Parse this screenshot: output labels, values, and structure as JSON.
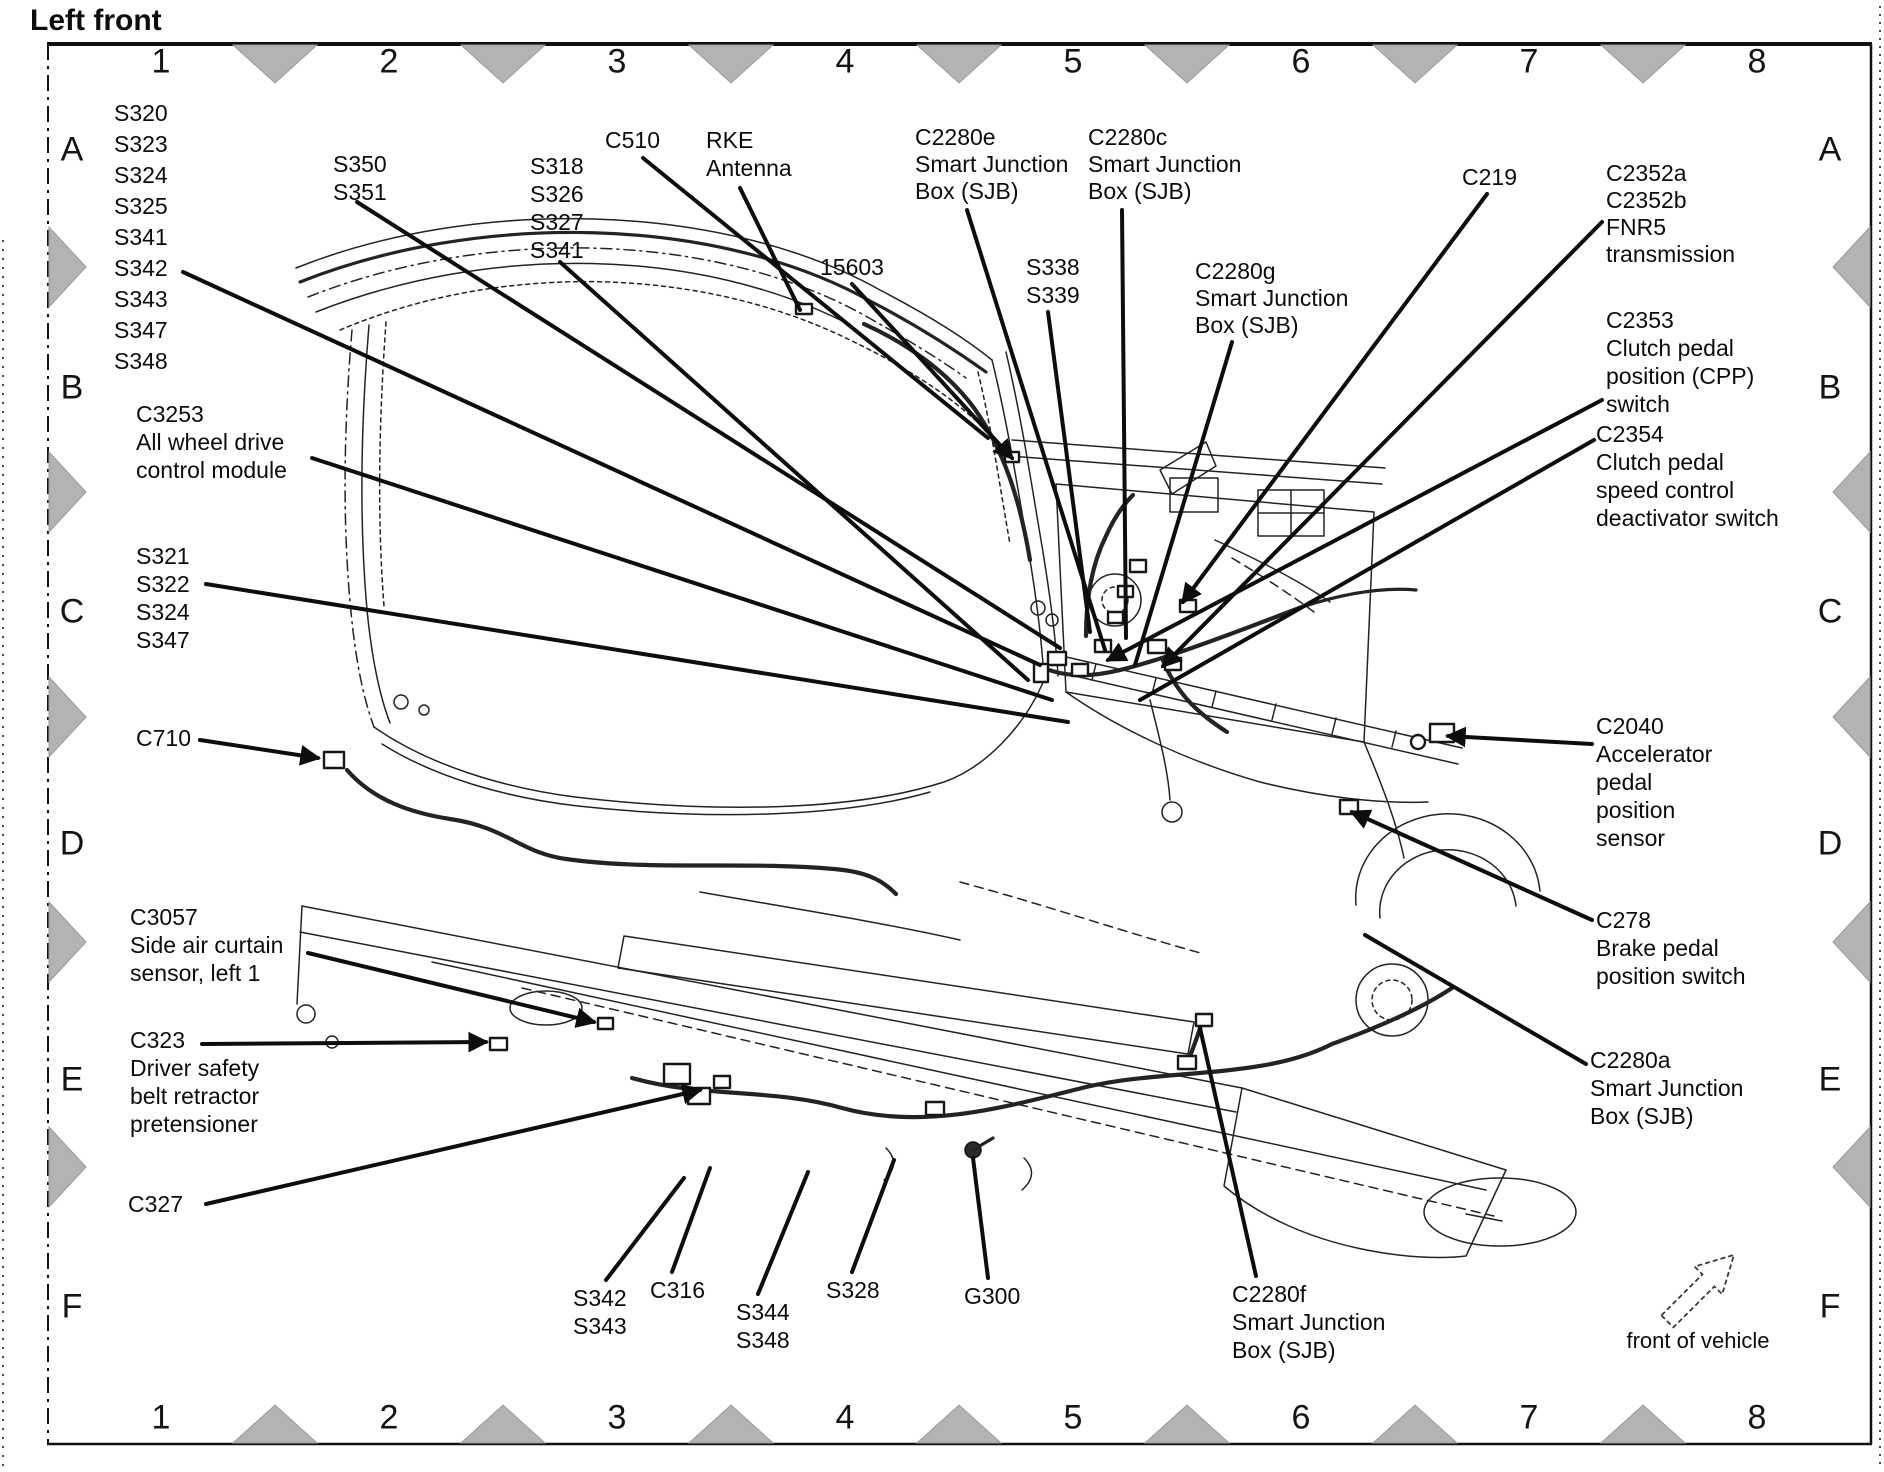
{
  "title": "Left front",
  "compass_label": "front of vehicle",
  "colors": {
    "ink": "#0d0d0d",
    "triangle_gray": "#b3b3b3",
    "paper": "#ffffff"
  },
  "grid": {
    "top_numbers": [
      "1",
      "2",
      "3",
      "4",
      "5",
      "6",
      "7",
      "8"
    ],
    "bottom_numbers": [
      "1",
      "2",
      "3",
      "4",
      "5",
      "6",
      "7",
      "8"
    ],
    "left_letters": [
      "A",
      "B",
      "C",
      "D",
      "E",
      "F"
    ],
    "right_letters": [
      "A",
      "B",
      "C",
      "D",
      "E",
      "F"
    ]
  },
  "callouts": [
    {
      "id": "splice-group-a1",
      "x": 114,
      "y": 98,
      "lh": 31,
      "lines": [
        "S320",
        "S323",
        "S324",
        "S325",
        "S341",
        "S342",
        "S343",
        "S347",
        "S348"
      ],
      "leaders": [
        [
          183,
          272,
          1040,
          665,
          false
        ]
      ]
    },
    {
      "id": "s350-s351",
      "x": 333,
      "y": 150,
      "lh": 28,
      "lines": [
        "S350",
        "S351"
      ],
      "leaders": [
        [
          357,
          202,
          1060,
          648,
          false
        ]
      ]
    },
    {
      "id": "s318-group",
      "x": 530,
      "y": 152,
      "lh": 28,
      "lines": [
        "S318",
        "S326",
        "S327",
        "S341"
      ],
      "leaders": [
        [
          560,
          262,
          1028,
          680,
          false
        ]
      ]
    },
    {
      "id": "c510",
      "x": 605,
      "y": 126,
      "lh": 28,
      "lines": [
        "C510"
      ],
      "leaders": [
        [
          643,
          158,
          988,
          438,
          false
        ]
      ]
    },
    {
      "id": "rke-antenna",
      "x": 706,
      "y": 126,
      "lh": 28,
      "lines": [
        "RKE",
        "Antenna"
      ],
      "leaders": [
        [
          740,
          188,
          800,
          310,
          false
        ]
      ]
    },
    {
      "id": "n15603",
      "x": 820,
      "y": 253,
      "lh": 28,
      "lines": [
        "15603"
      ],
      "leaders": [
        [
          852,
          284,
          1012,
          458,
          true
        ]
      ]
    },
    {
      "id": "c2280e",
      "x": 915,
      "y": 124,
      "lh": 27,
      "lines": [
        "C2280e",
        "Smart Junction",
        "Box (SJB)"
      ],
      "leaders": [
        [
          967,
          210,
          1105,
          650,
          false
        ]
      ]
    },
    {
      "id": "c2280c",
      "x": 1088,
      "y": 124,
      "lh": 27,
      "lines": [
        "C2280c",
        "Smart Junction",
        "Box (SJB)"
      ],
      "leaders": [
        [
          1122,
          210,
          1126,
          638,
          false
        ]
      ]
    },
    {
      "id": "s338-s339",
      "x": 1026,
      "y": 253,
      "lh": 28,
      "lines": [
        "S338",
        "S339"
      ],
      "leaders": [
        [
          1048,
          312,
          1090,
          632,
          false
        ]
      ]
    },
    {
      "id": "c2280g",
      "x": 1195,
      "y": 258,
      "lh": 27,
      "lines": [
        "C2280g",
        "Smart Junction",
        "Box (SJB)"
      ],
      "leaders": [
        [
          1232,
          342,
          1135,
          665,
          false
        ]
      ]
    },
    {
      "id": "c219",
      "x": 1462,
      "y": 163,
      "lh": 28,
      "lines": [
        "C219"
      ],
      "leaders": [
        [
          1487,
          194,
          1183,
          602,
          true
        ]
      ]
    },
    {
      "id": "c2352-fnr5",
      "x": 1606,
      "y": 160,
      "lh": 27,
      "lines": [
        "C2352a",
        "C2352b",
        "FNR5",
        "transmission"
      ],
      "leaders": [
        [
          1602,
          222,
          1163,
          666,
          true
        ]
      ]
    },
    {
      "id": "c2353-cpp",
      "x": 1606,
      "y": 306,
      "lh": 28,
      "lines": [
        "C2353",
        "Clutch pedal",
        "position (CPP)",
        "switch"
      ],
      "leaders": [
        [
          1602,
          400,
          1108,
          660,
          true
        ]
      ]
    },
    {
      "id": "c2354-deactivator",
      "x": 1596,
      "y": 420,
      "lh": 28,
      "lines": [
        "C2354",
        "Clutch pedal",
        "speed control",
        "deactivator switch"
      ],
      "leaders": [
        [
          1594,
          440,
          1140,
          700,
          false
        ]
      ]
    },
    {
      "id": "c2040-app-sensor",
      "x": 1596,
      "y": 712,
      "lh": 28,
      "lines": [
        "C2040",
        "Accelerator",
        "pedal",
        "position",
        "sensor"
      ],
      "leaders": [
        [
          1592,
          744,
          1448,
          736,
          true
        ]
      ]
    },
    {
      "id": "c278-bpp-switch",
      "x": 1596,
      "y": 906,
      "lh": 28,
      "lines": [
        "C278",
        "Brake pedal",
        "position switch"
      ],
      "leaders": [
        [
          1592,
          920,
          1352,
          812,
          true
        ]
      ]
    },
    {
      "id": "c2280a",
      "x": 1590,
      "y": 1046,
      "lh": 28,
      "lines": [
        "C2280a",
        "Smart Junction",
        "Box (SJB)"
      ],
      "leaders": [
        [
          1586,
          1064,
          1365,
          935,
          false
        ]
      ]
    },
    {
      "id": "c3253-awd",
      "x": 136,
      "y": 400,
      "lh": 28,
      "lines": [
        "C3253",
        "All wheel drive",
        "control module"
      ],
      "leaders": [
        [
          312,
          458,
          1052,
          700,
          false
        ]
      ]
    },
    {
      "id": "s321-group",
      "x": 136,
      "y": 542,
      "lh": 28,
      "lines": [
        "S321",
        "S322",
        "S324",
        "S347"
      ],
      "leaders": [
        [
          206,
          584,
          1068,
          722,
          false
        ]
      ]
    },
    {
      "id": "c710",
      "x": 136,
      "y": 724,
      "lh": 28,
      "lines": [
        "C710"
      ],
      "leaders": [
        [
          200,
          740,
          318,
          758,
          true
        ]
      ]
    },
    {
      "id": "c3057-air-curtain",
      "x": 130,
      "y": 903,
      "lh": 28,
      "lines": [
        "C3057",
        "Side air curtain",
        "sensor, left 1"
      ],
      "leaders": [
        [
          308,
          953,
          594,
          1022,
          true
        ]
      ]
    },
    {
      "id": "c323-pretensioner",
      "x": 130,
      "y": 1026,
      "lh": 28,
      "lines": [
        "C323",
        "Driver safety",
        "belt retractor",
        "pretensioner"
      ],
      "leaders": [
        [
          202,
          1044,
          486,
          1042,
          true
        ]
      ]
    },
    {
      "id": "c327",
      "x": 128,
      "y": 1190,
      "lh": 28,
      "lines": [
        "C327"
      ],
      "leaders": [
        [
          206,
          1204,
          700,
          1090,
          true
        ]
      ]
    },
    {
      "id": "s342-s343",
      "x": 573,
      "y": 1284,
      "lh": 28,
      "lines": [
        "S342",
        "S343"
      ],
      "leaders": [
        [
          606,
          1280,
          684,
          1178,
          false
        ]
      ]
    },
    {
      "id": "c316",
      "x": 650,
      "y": 1276,
      "lh": 28,
      "lines": [
        "C316"
      ],
      "leaders": [
        [
          672,
          1272,
          710,
          1168,
          false
        ]
      ]
    },
    {
      "id": "s344-s348",
      "x": 736,
      "y": 1298,
      "lh": 28,
      "lines": [
        "S344",
        "S348"
      ],
      "leaders": [
        [
          758,
          1294,
          808,
          1172,
          false
        ]
      ]
    },
    {
      "id": "s328",
      "x": 826,
      "y": 1276,
      "lh": 28,
      "lines": [
        "S328"
      ],
      "leaders": [
        [
          852,
          1272,
          894,
          1160,
          false
        ]
      ]
    },
    {
      "id": "g300",
      "x": 964,
      "y": 1282,
      "lh": 28,
      "lines": [
        "G300"
      ],
      "leaders": [
        [
          988,
          1278,
          973,
          1158,
          false
        ]
      ]
    },
    {
      "id": "c2280f",
      "x": 1232,
      "y": 1280,
      "lh": 28,
      "lines": [
        "C2280f",
        "Smart Junction",
        "Box (SJB)"
      ],
      "leaders": [
        [
          1256,
          1276,
          1200,
          1028,
          false
        ]
      ]
    }
  ]
}
